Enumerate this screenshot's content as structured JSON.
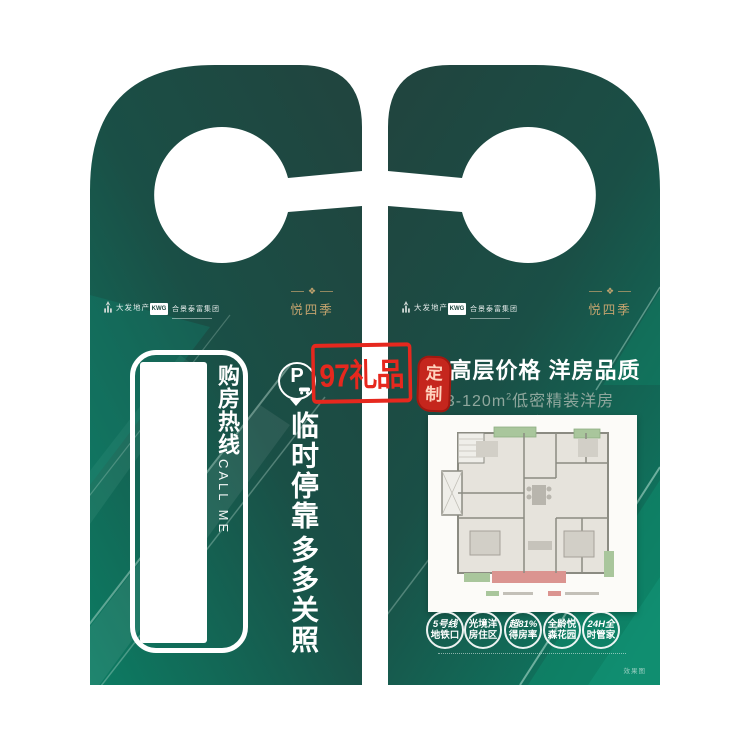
{
  "watermark": {
    "label": "97礼品"
  },
  "seal": {
    "char1": "定",
    "char2": "制"
  },
  "brand": {
    "developer1": "大发地产",
    "developer2_abbr": "KWG",
    "developer2_name": "合景泰富集团",
    "project_name": "悦四季",
    "ornament": "❖"
  },
  "front": {
    "hotline_label": "购房热线",
    "hotline_sub": "CALL ME",
    "parking_letter": "P",
    "slogan_line1": "临时停靠",
    "slogan_line2": "多多关照"
  },
  "back": {
    "headline_divider": "|",
    "headline": "高层价格 洋房品质",
    "area_prefix": "93-120m",
    "area_sup": "2",
    "area_suffix": "低密精装洋房",
    "badges": [
      {
        "line1": "5号线",
        "line2": "地铁口"
      },
      {
        "line1": "光境洋",
        "line2": "房住区"
      },
      {
        "line1": "超81%",
        "line2": "得房率"
      },
      {
        "line1": "全龄悦",
        "line2": "森花园"
      },
      {
        "line1": "24H全",
        "line2": "时管家"
      }
    ],
    "render_note": "效果图"
  },
  "colors": {
    "deep_green": "#1f443e",
    "teal": "#0c7c63",
    "gold": "#c3a36e",
    "watermark_red": "#e6281e",
    "seal_red": "#c5261d",
    "plan_green": "#a9c69c",
    "plan_pink": "#db9490"
  }
}
